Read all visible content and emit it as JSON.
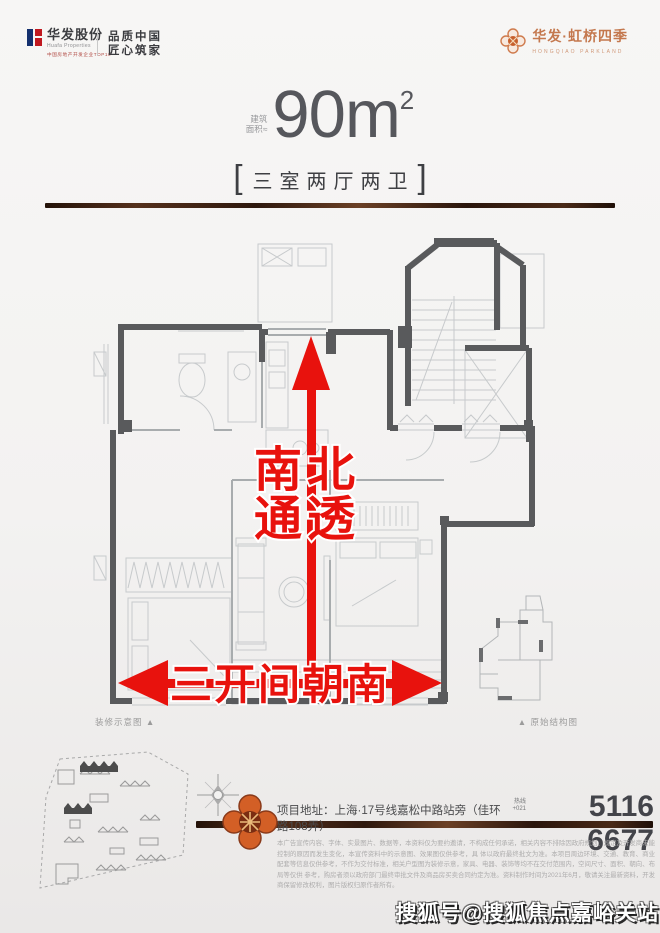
{
  "header": {
    "left": {
      "brand": "华发股份",
      "brand_en": "Huafa Properties",
      "certification": "中国房地产开发企业TOP10",
      "slogan_line1": "品质中国",
      "slogan_line2": "匠心筑家"
    },
    "right": {
      "brand": "华发·虹桥四季",
      "brand_en": "HONGQIAO PARKLAND"
    }
  },
  "hero": {
    "area_prefix_line1": "建筑",
    "area_prefix_line2": "面积≈",
    "area_value": "90m",
    "area_sup": "2",
    "bracket_left": "[",
    "bracket_right": "]",
    "layout": "三室两厅两卫"
  },
  "plan": {
    "annotation_ns_line1": "南北",
    "annotation_ns_line2": "通透",
    "annotation_south": "三开间朝南",
    "caption_left": "装修示意图 ▲",
    "caption_right": "▲  原始结构图"
  },
  "footer": {
    "address_label": "项目地址：",
    "address": "上海·17号线嘉松中路站旁（佳环路108弄）",
    "hotline_line1": "热线",
    "hotline_line2": "+021",
    "phone": "5116 6677",
    "disclaimer_line1": "本广告宣传内容、字体、实景图片、数据等，本资料仅为要约邀请，不构成任何承诺，相关内容不排除因政府规划、规定及开发商未能控制的原因而发生变化，本宣传资料中的示意图、效果图仅供参考，具",
    "disclaimer_line2": "体以政府最终批文为准。本项目周边环境、交通、教育、商业配套等信息仅供参考，不作为交付标准，相关户型图为装修示意，家具、电器、装饰等均不在交付范围内，空间尺寸、面积、朝向、布局等仅供",
    "disclaimer_line3": "参考，购房者须以政府部门最终审批文件及商品房买卖合同约定为准。资料制作时间为2021年6月，敬请关注最新资料，开发商保留修改权利，图片版权归原作者所有。"
  },
  "watermark": "搜狐号@搜狐焦点嘉峪关站",
  "colors": {
    "accent_red": "#e8120d",
    "brand_orange": "#c4784e",
    "bar_brown": "#55301c",
    "wall_gray": "#595a5c",
    "line_gray": "#c7cacc",
    "text_dark": "#55565a"
  }
}
